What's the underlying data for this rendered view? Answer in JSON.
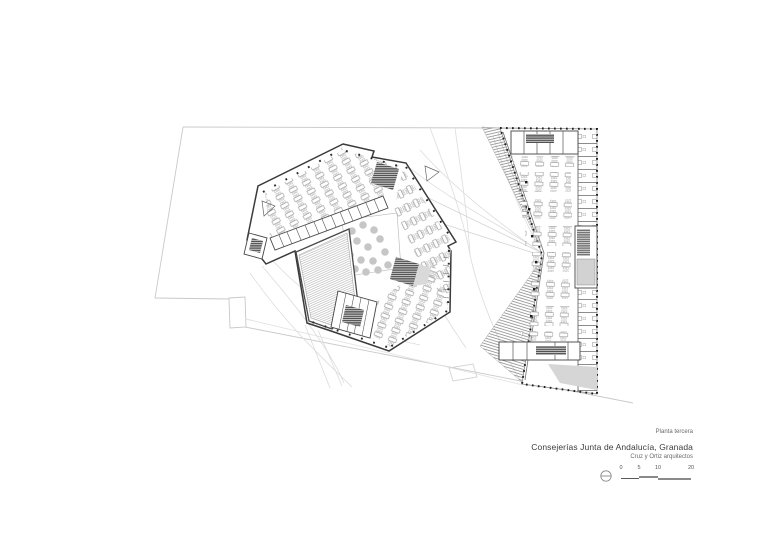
{
  "sheet": {
    "plan_label": "Planta tercera",
    "project_title": "Consejerías Junta de Andalucía, Granada",
    "architects": "Cruz y Ortiz arquitectos"
  },
  "scale_bar": {
    "ticks": [
      "0",
      "5",
      "10",
      "20"
    ]
  },
  "colors": {
    "paper": "#ffffff",
    "wall": "#3a3a3a",
    "site_line": "#c9c9c9",
    "terrain_line": "#dcdcdc",
    "hatch": "#9a9a9a",
    "tree": "#c6c6c6",
    "shade": "#d6d6d6",
    "core_dark": "#4f4f4f"
  }
}
